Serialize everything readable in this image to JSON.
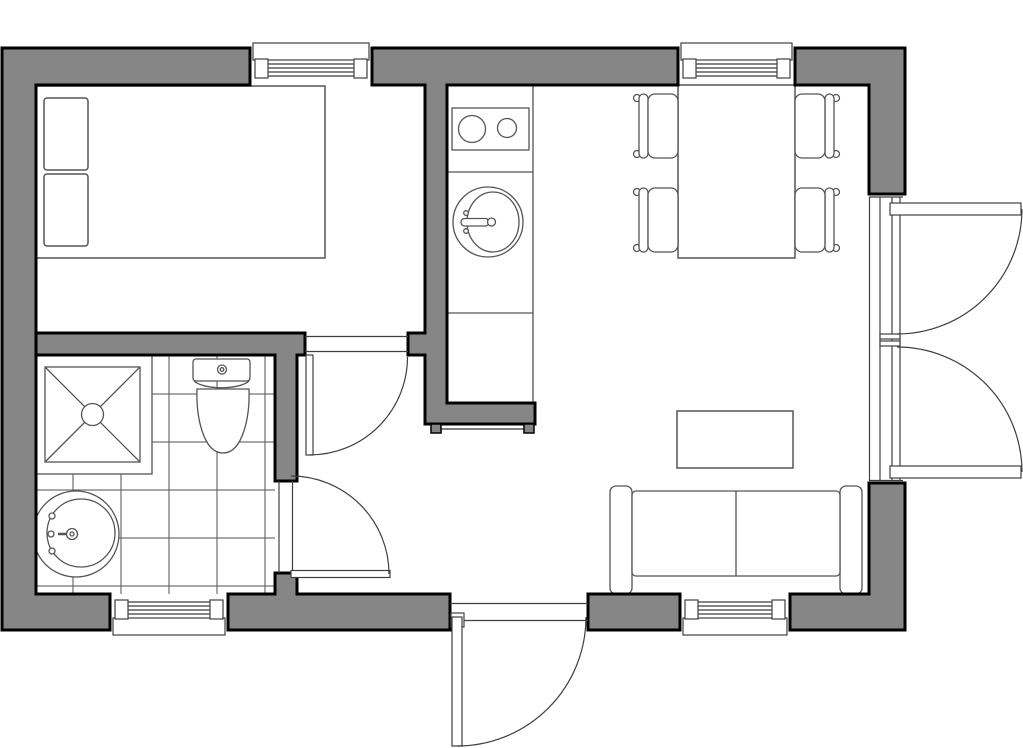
{
  "meta": {
    "title": "apartment-floor-plan",
    "visible_text_on_image": "none"
  },
  "colors": {
    "floor": "#ffffff",
    "wall_fill": "#868686",
    "outline": "#000000",
    "furniture_line": "#555555",
    "tile_line": "#4f4f4f",
    "opening_line": "#3f3f3f"
  },
  "rooms": [
    {
      "name": "bedroom",
      "furniture": [
        "double-bed",
        "pillow",
        "pillow"
      ],
      "windows": 1,
      "doors": [
        "bedroom-door"
      ]
    },
    {
      "name": "bathroom",
      "furniture": [
        "shower",
        "toilet",
        "pedestal-sink"
      ],
      "floor_finish": "tiled",
      "windows": 1,
      "doors": [
        "bathroom-door"
      ]
    },
    {
      "name": "kitchen",
      "furniture": [
        "counter",
        "cooktop-2-burner",
        "kitchen-sink"
      ]
    },
    {
      "name": "dining-area",
      "furniture": [
        "dining-table",
        "chair",
        "chair",
        "chair",
        "chair"
      ],
      "windows": 1
    },
    {
      "name": "living-area",
      "furniture": [
        "sofa-2-seat",
        "coffee-table"
      ],
      "windows": 1,
      "doors": [
        "french-doors"
      ]
    },
    {
      "name": "hall",
      "doors": [
        "entrance-door"
      ]
    }
  ],
  "openings": {
    "windows_total": 4,
    "interior_swing_doors": 2,
    "entrance_doors": 1,
    "french_door_leaves": 2
  }
}
